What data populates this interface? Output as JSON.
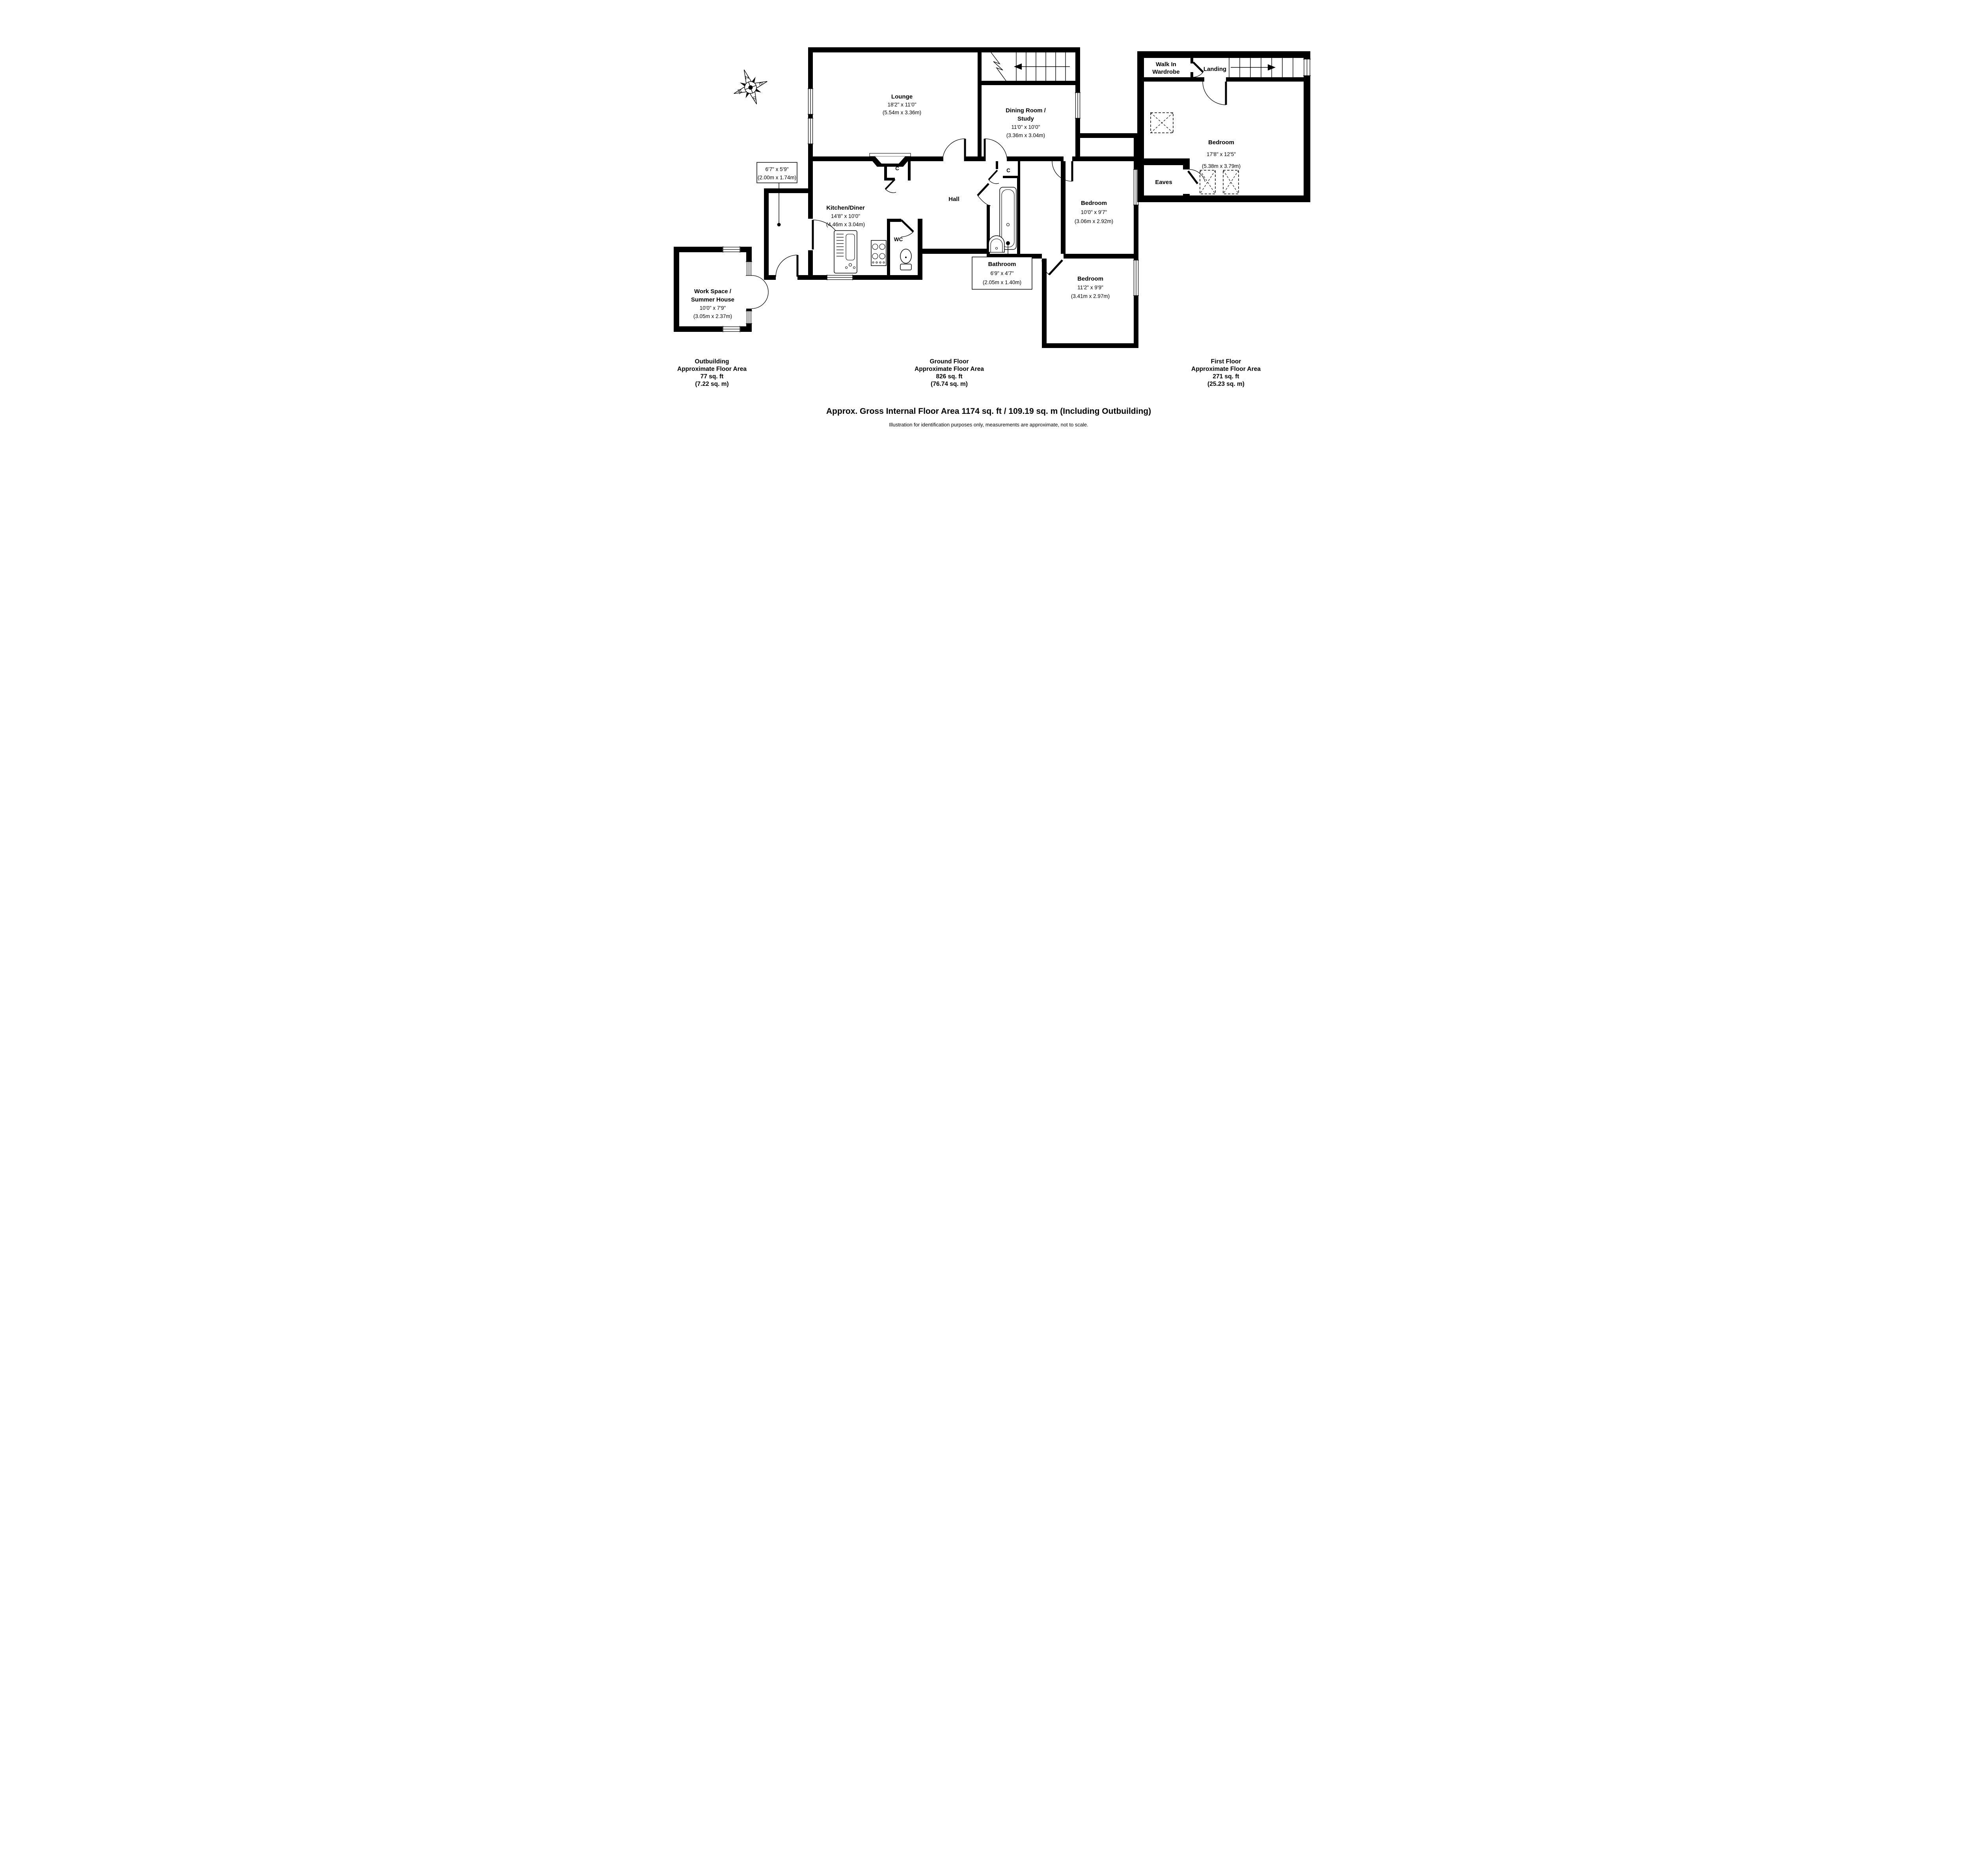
{
  "compass": {
    "north": "N",
    "east": "E",
    "south": "S",
    "west": "W"
  },
  "rooms": {
    "lounge": {
      "name": "Lounge",
      "imperial": "18'2\" x 11'0\"",
      "metric": "(5.54m x 3.36m)"
    },
    "dining": {
      "name_line1": "Dining Room /",
      "name_line2": "Study",
      "imperial": "11'0\" x 10'0\"",
      "metric": "(3.36m x 3.04m)"
    },
    "kitchen": {
      "name": "Kitchen/Diner",
      "imperial": "14'8\" x 10'0\"",
      "metric": "(4.46m x 3.04m)"
    },
    "hall": {
      "name": "Hall"
    },
    "wc": {
      "name": "WC"
    },
    "closet1": {
      "name": "C"
    },
    "closet2": {
      "name": "C"
    },
    "porch": {
      "imperial": "6'7\" x 5'9\"",
      "metric": "(2.00m x 1.74m)"
    },
    "bathroom": {
      "name": "Bathroom",
      "imperial": "6'9\" x 4'7\"",
      "metric": "(2.05m x 1.40m)"
    },
    "bedroom1": {
      "name": "Bedroom",
      "imperial": "10'0\" x 9'7\"",
      "metric": "(3.06m x 2.92m)"
    },
    "bedroom2": {
      "name": "Bedroom",
      "imperial": "11'2\" x 9'9\"",
      "metric": "(3.41m x 2.97m)"
    },
    "ff_bedroom": {
      "name": "Bedroom",
      "imperial": "17'8\" x 12'5\"",
      "metric": "(5.38m x 3.79m)"
    },
    "wardrobe": {
      "name_line1": "Walk In",
      "name_line2": "Wardrobe"
    },
    "landing": {
      "name": "Landing"
    },
    "eaves": {
      "name": "Eaves"
    },
    "workspace": {
      "name_line1": "Work Space /",
      "name_line2": "Summer House",
      "imperial": "10'0\" x 7'9\"",
      "metric": "(3.05m x 2.37m)"
    }
  },
  "captions": {
    "outbuilding": [
      "Outbuilding",
      "Approximate Floor Area",
      "77 sq. ft",
      "(7.22 sq. m)"
    ],
    "ground": [
      "Ground Floor",
      "Approximate Floor Area",
      "826 sq. ft",
      "(76.74 sq. m)"
    ],
    "first": [
      "First Floor",
      "Approximate Floor Area",
      "271 sq. ft",
      "(25.23 sq. m)"
    ]
  },
  "footer": {
    "summary": "Approx. Gross Internal Floor Area 1174 sq. ft / 109.19 sq. m (Including Outbuilding)",
    "disclaimer": "Illustration for identification purposes only, measurements are approximate, not to scale."
  }
}
